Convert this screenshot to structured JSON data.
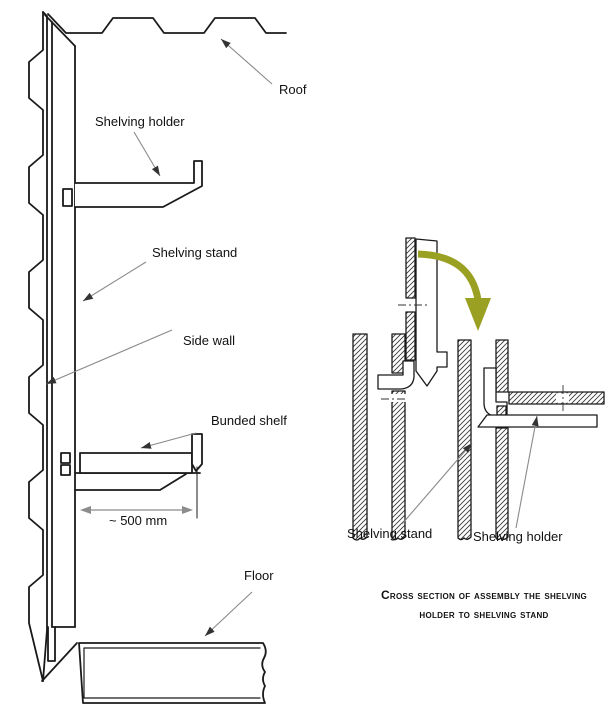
{
  "colors": {
    "background": "#ffffff",
    "ink": "#1a1a1a",
    "leader": "#8a8a8a",
    "dimension": "#8c8c8c",
    "insertion_arrow": "#9aa021"
  },
  "elevation": {
    "labels": {
      "roof": "Roof",
      "shelving_holder": "Shelving holder",
      "shelving_stand": "Shelving stand",
      "side_wall": "Side wall",
      "bunded_shelf": "Bunded shelf",
      "dimension": "~ 500 mm",
      "floor": "Floor"
    }
  },
  "cross_section": {
    "labels": {
      "shelving_stand": "Shelving stand",
      "shelving_holder": "Shelving holder"
    },
    "caption": [
      "Cross section of assembly the shelving",
      "holder to shelving stand"
    ]
  }
}
